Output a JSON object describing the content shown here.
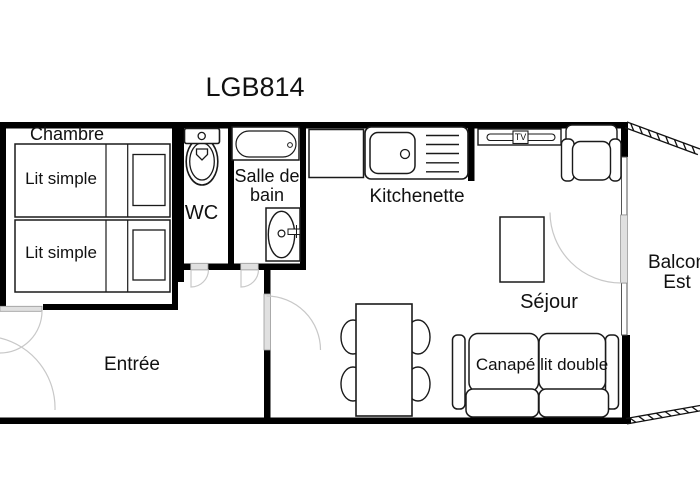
{
  "title": "LGB814",
  "rooms": {
    "chambre": "Chambre",
    "wc": "WC",
    "salle_de_bain_line1": "Salle de",
    "salle_de_bain_line2": "bain",
    "kitchenette": "Kitchenette",
    "sejour": "Séjour",
    "entree": "Entrée",
    "balcon_line1": "Balcon",
    "balcon_line2": "Est"
  },
  "furniture": {
    "bed1": "Lit simple",
    "bed2": "Lit simple",
    "sofa": "Canapé lit double",
    "tv": "TV"
  },
  "colors": {
    "wall": "#000000",
    "furniture_stroke": "#1a1a1a",
    "door_leaf": "#e0e0e0",
    "door_arc": "#c8c8c8",
    "background": "#ffffff"
  }
}
